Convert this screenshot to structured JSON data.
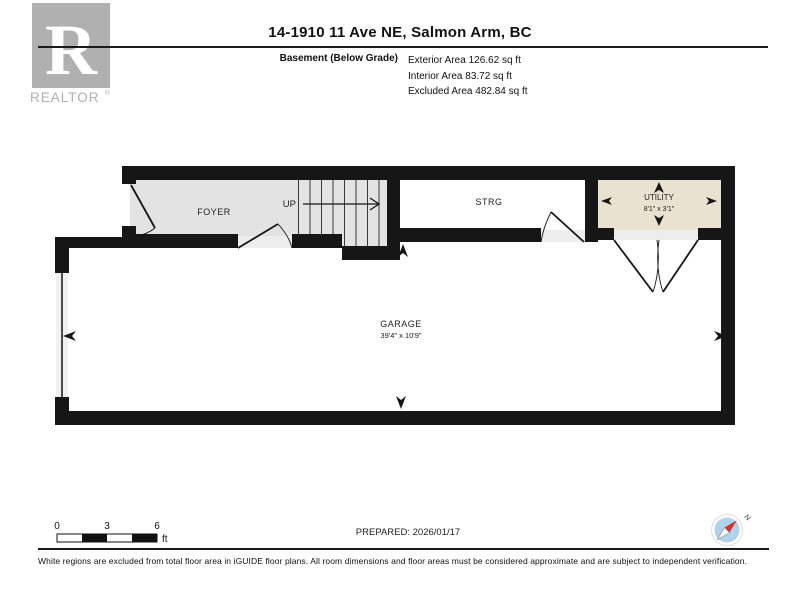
{
  "header": {
    "title": "14-1910 11 Ave NE, Salmon Arm, BC",
    "logo": {
      "r": "R",
      "text": "REALTOR",
      "registered": "®"
    },
    "floor_label": "Basement (Below Grade)",
    "areas": [
      "Exterior Area 126.62 sq ft",
      "Interior Area 83.72 sq ft",
      "Excluded Area 482.84 sq ft"
    ]
  },
  "floorplan": {
    "rooms": [
      {
        "name": "FOYER",
        "dims": ""
      },
      {
        "name": "STRG",
        "dims": ""
      },
      {
        "name": "UTILITY",
        "dims": "8'1\" x 3'1\""
      },
      {
        "name": "GARAGE",
        "dims": "39'4\" x 10'9\""
      }
    ],
    "stairs": {
      "label": "UP"
    },
    "colors": {
      "wall": "#161616",
      "foyer_fill": "#e3e3e3",
      "utility_fill": "#eae2d0",
      "room_fill": "#ffffff",
      "threshold_fill": "#ededed"
    }
  },
  "footer": {
    "scale": {
      "ticks": [
        "0",
        "3",
        "6"
      ],
      "unit": "ft"
    },
    "prepared": "PREPARED: 2026/01/17",
    "compass_label": "N",
    "disclaimer": "White regions are excluded from total floor area in iGUIDE floor plans. All room dimensions and floor areas must be considered approximate and are subject to independent verification."
  }
}
